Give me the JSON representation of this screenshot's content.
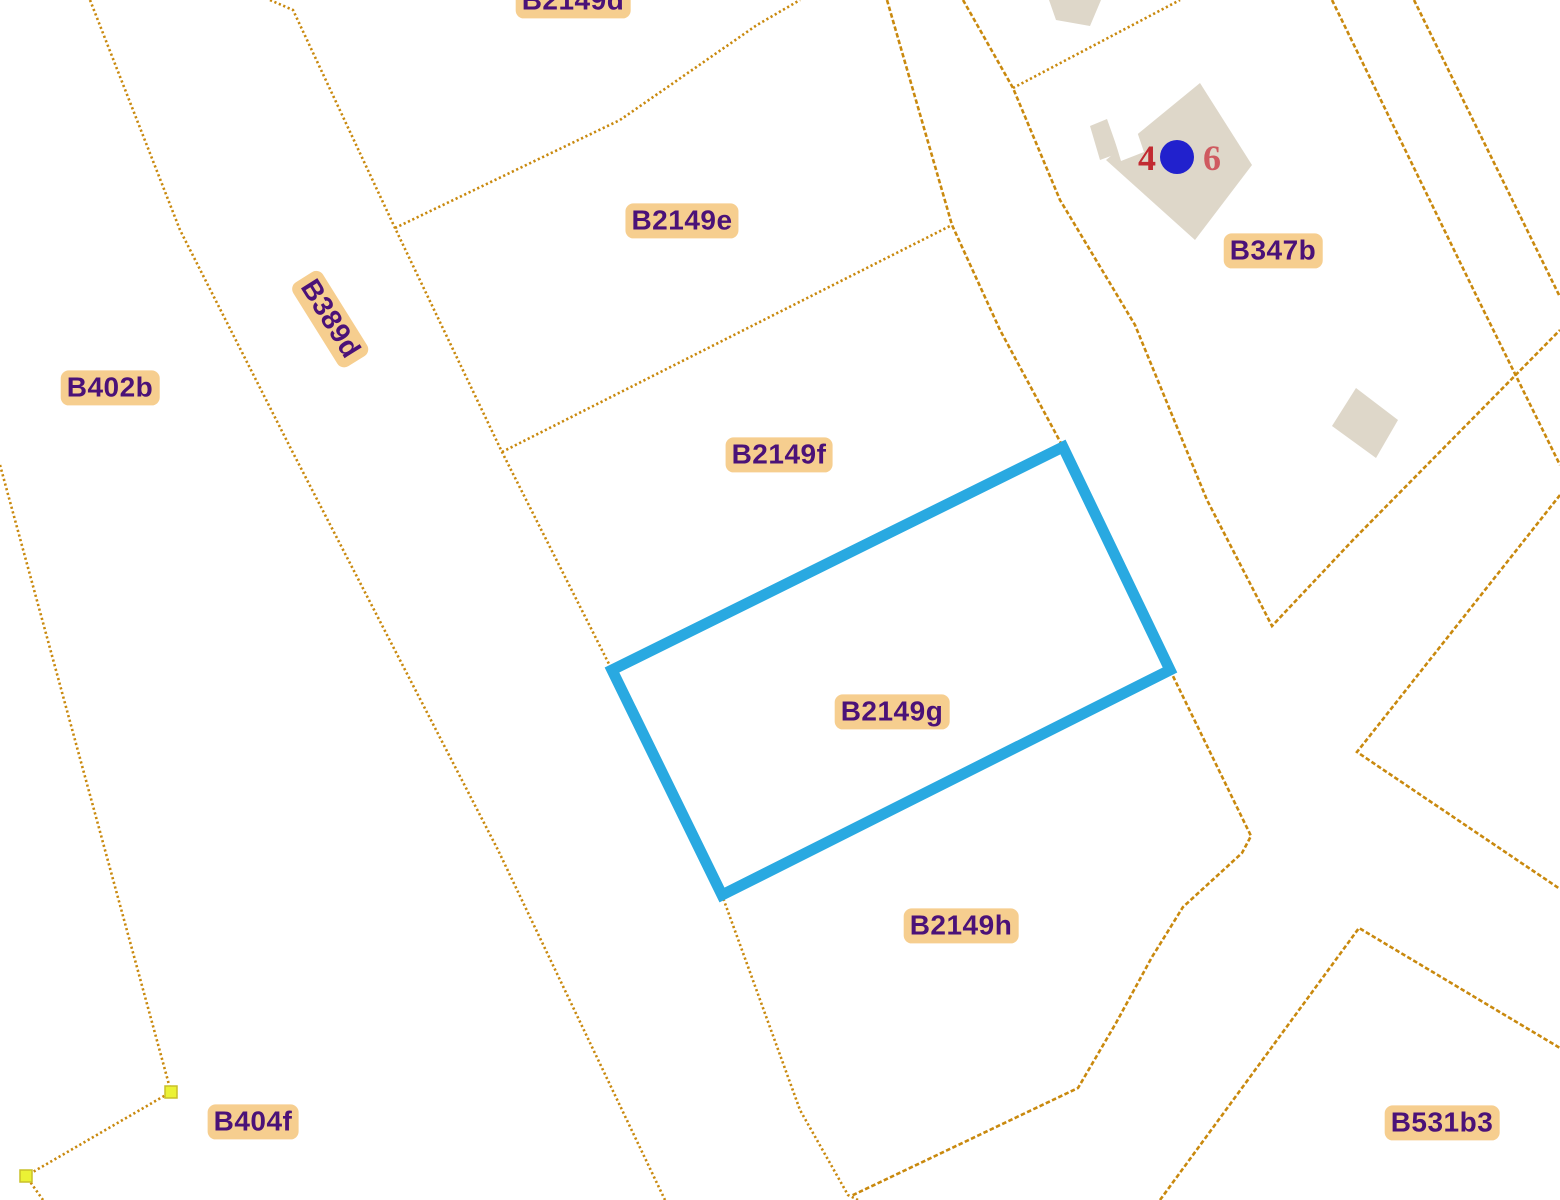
{
  "map": {
    "type": "cadastral-parcel-map",
    "background_color": "#ffffff",
    "boundary_line_color": "#c9890e",
    "highlight_color": "#29a9e1",
    "label_background_color": "#f6ce8f",
    "label_text_color": "#4b1278",
    "building_fill_color": "#ded7c9",
    "vertex_marker_color": "#ebf235",
    "vertex_marker_border_color": "#c9c029",
    "address_number_color": "#c22a31",
    "address_number_faded_color": "#cf5a60",
    "address_point_color": "#2121cd",
    "selected_parcel": "B2149g",
    "parcel_labels": [
      {
        "id": "B2149d",
        "text": "B2149d",
        "x": 573,
        "y": 1,
        "rotation": 0
      },
      {
        "id": "B2149e",
        "text": "B2149e",
        "x": 682,
        "y": 221,
        "rotation": 0
      },
      {
        "id": "B2149f",
        "text": "B2149f",
        "x": 779,
        "y": 455,
        "rotation": 0
      },
      {
        "id": "B2149g",
        "text": "B2149g",
        "x": 892,
        "y": 712,
        "rotation": 0
      },
      {
        "id": "B2149h",
        "text": "B2149h",
        "x": 961,
        "y": 926,
        "rotation": 0
      },
      {
        "id": "B347b",
        "text": "B347b",
        "x": 1273,
        "y": 251,
        "rotation": 0
      },
      {
        "id": "B402b",
        "text": "B402b",
        "x": 110,
        "y": 388,
        "rotation": 0
      },
      {
        "id": "B389d",
        "text": "B389d",
        "x": 330,
        "y": 319,
        "rotation": 58
      },
      {
        "id": "B404f",
        "text": "B404f",
        "x": 253,
        "y": 1122,
        "rotation": 0
      },
      {
        "id": "B531b3",
        "text": "B531b3",
        "x": 1442,
        "y": 1123,
        "rotation": 0
      }
    ],
    "boundary_lines": [
      {
        "name": "parcel-boundary-B402b-west",
        "points": "0,465 171,1092 26,1176 43,1200",
        "style": "dotted"
      },
      {
        "name": "road-B389d-west-edge",
        "points": "90,0 180,230 290,447 498,850 665,1200",
        "style": "dotted"
      },
      {
        "name": "road-B389d-east-edge-block-west",
        "points": "270,0 293,10 395,228 502,452 612,670 722,895 800,1110 848,1195 858,1200",
        "style": "dotted"
      },
      {
        "name": "boundary-B2149d-B2149e",
        "points": "395,228 620,120 757,25 800,0",
        "style": "dotted"
      },
      {
        "name": "boundary-B2149e-B2149f",
        "points": "502,452 952,225",
        "style": "dotted"
      },
      {
        "name": "block-northeast-boundary",
        "points": "887,0 952,225 1000,330 1063,447",
        "style": "dashed"
      },
      {
        "name": "road-east-edge-B347b-west",
        "points": "963,0 1013,88 1060,200 1135,325 1207,500 1272,626 1353,540 1560,330",
        "style": "dashed"
      },
      {
        "name": "boundary-B2149h-east",
        "points": "1170,670 1251,836 1242,853 1183,907 1152,957 1116,1023 1078,1088 851,1196",
        "style": "dashed"
      },
      {
        "name": "boundary-B347b-northwest",
        "points": "1013,88 1180,0",
        "style": "dotted"
      },
      {
        "name": "boundary-B347b-east",
        "points": "1332,0 1477,297 1560,465",
        "style": "dashed"
      },
      {
        "name": "top-right-corner-boundary",
        "points": "1414,0 1560,297",
        "style": "dashed"
      },
      {
        "name": "parcel-B531b3-north-boundary",
        "points": "1160,1200 1359,928 1560,1048",
        "style": "dashed"
      },
      {
        "name": "road-fork-east-wedge",
        "points": "1560,495 1357,752 1560,889",
        "style": "dashed"
      }
    ],
    "highlighted_parcel_outline": {
      "parcel": "B2149g",
      "points": "1063,447 1170,670 722,895 612,670",
      "stroke_width": 11
    },
    "vertex_markers": [
      {
        "x": 171,
        "y": 1092
      },
      {
        "x": 26,
        "y": 1176
      }
    ],
    "buildings": [
      {
        "name": "building-top-edge",
        "points": "1049,0 1101,0 1090,26 1056,20"
      },
      {
        "name": "building-B347b-main",
        "points": "1200,83 1252,165 1195,240 1106,160"
      },
      {
        "name": "building-B347b-main-wing",
        "points": "1090,126 1107,119 1119,153 1100,160"
      },
      {
        "name": "building-B347b-south",
        "points": "1356,388 1398,420 1376,458 1332,426"
      }
    ],
    "building_notches": [
      {
        "name": "building-B347b-notch",
        "points": "1108,118 1130,111 1144,152 1121,161"
      }
    ],
    "address_marker": {
      "number_left": "4",
      "number_right": "6",
      "left_x": 1147,
      "left_y": 170,
      "right_x": 1212,
      "right_y": 170,
      "point_x": 1177,
      "point_y": 157,
      "point_radius": 17
    }
  }
}
